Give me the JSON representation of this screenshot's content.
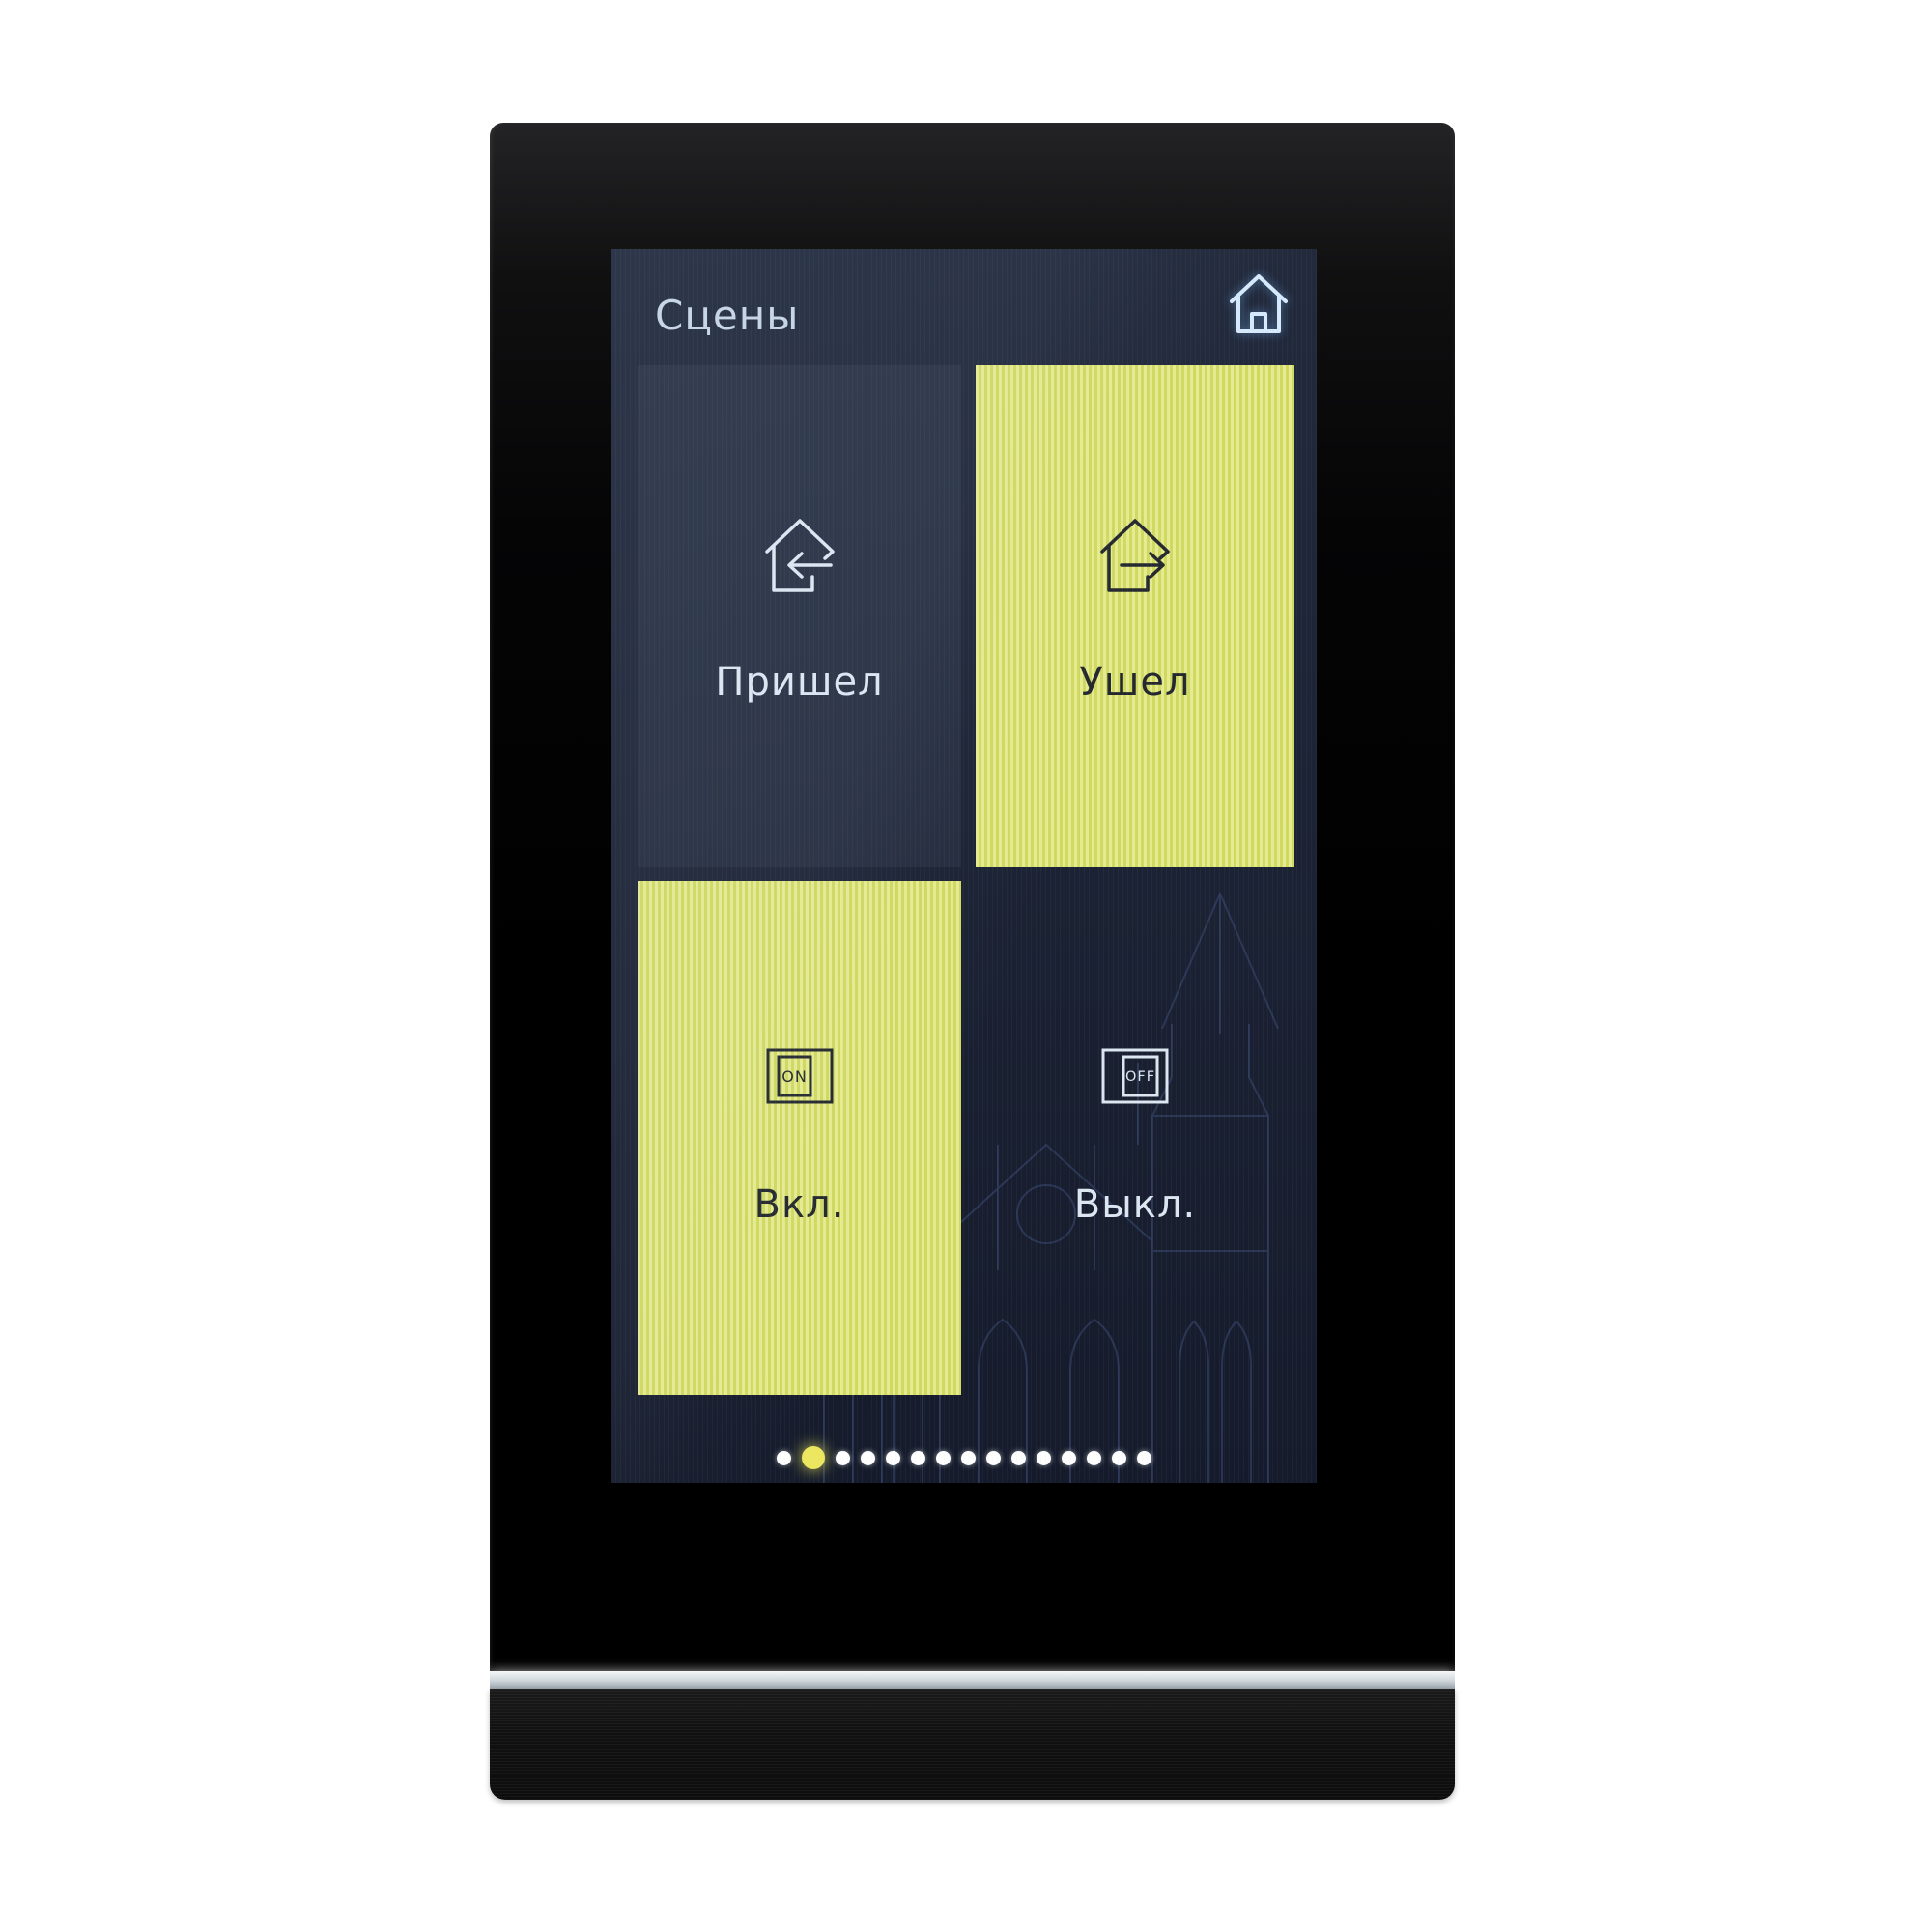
{
  "screen": {
    "header": {
      "title": "Сцены",
      "home_icon": "home-icon"
    },
    "tiles": [
      {
        "label": "Пришел",
        "icon": "house-arrow-in-icon",
        "active": false
      },
      {
        "label": "Ушел",
        "icon": "house-arrow-out-icon",
        "active": true
      },
      {
        "label": "Вкл.",
        "icon": "switch-on-icon",
        "icon_text": "ON",
        "active": true
      },
      {
        "label": "Выкл.",
        "icon": "switch-off-icon",
        "icon_text": "OFF",
        "active": false
      }
    ],
    "pagination": {
      "total_dots": 15,
      "active_index": 1
    },
    "colors": {
      "screen_bg": "#1c2334",
      "screen_bg_top": "#222a3c",
      "stripe_light": "#e6eb8f",
      "stripe_dark": "#d0d960",
      "text_light": "#dde7f2",
      "text_dark": "#24282e",
      "title": "#c7d5e4",
      "icon_light": "#d6eafc",
      "dot": "#ffffff",
      "dot_active": "#ece75e",
      "wallpaper_line": "#3a4a73",
      "light_bar": "#cfd6db"
    }
  }
}
